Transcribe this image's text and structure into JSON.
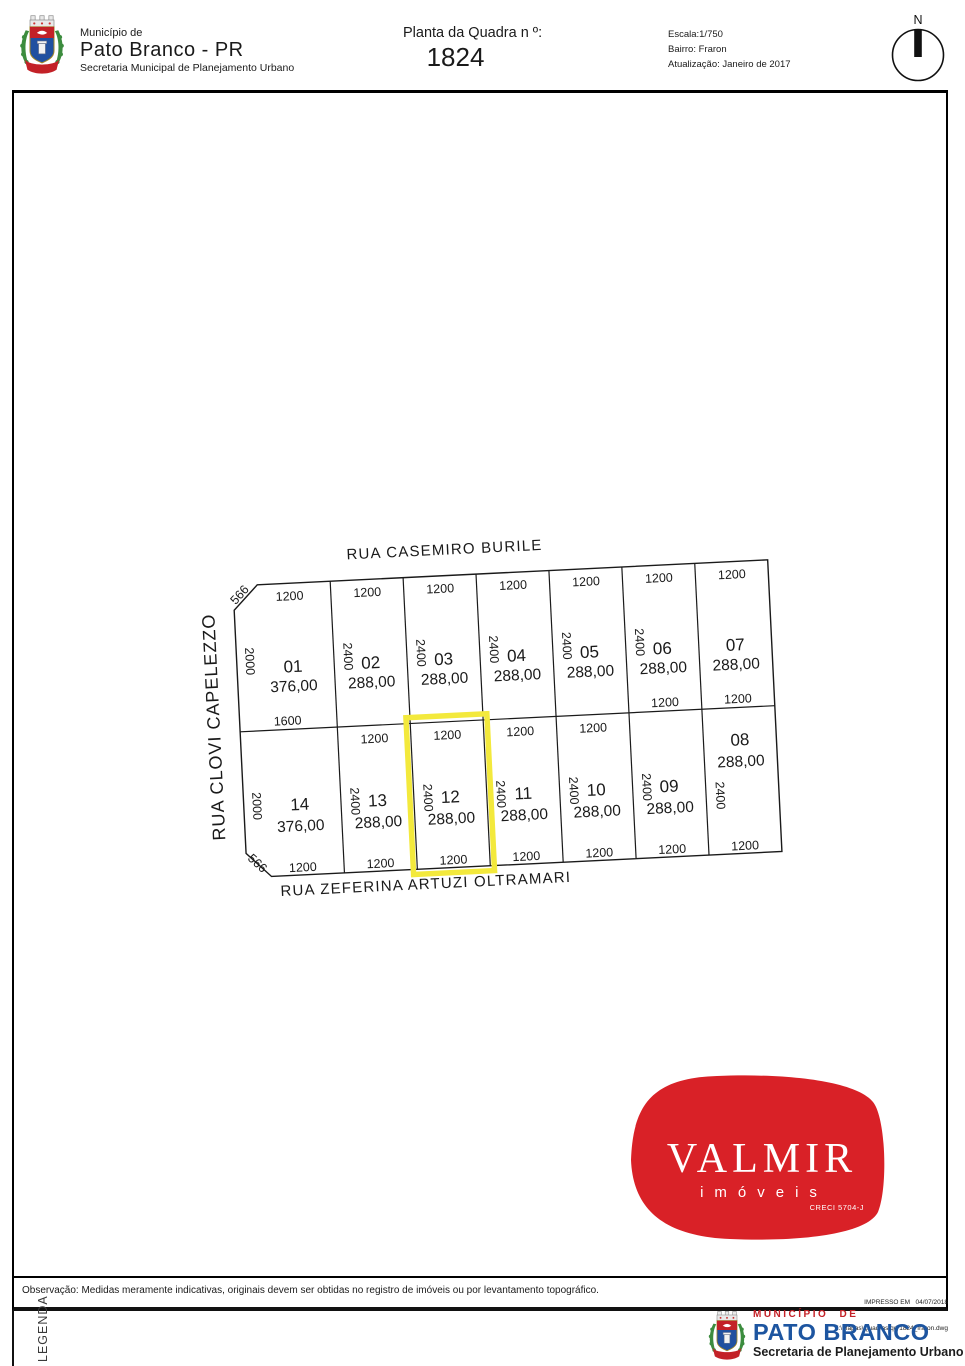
{
  "header": {
    "municipality_label": "Município de",
    "municipality": "Pato Branco - PR",
    "secretariat": "Secretaria Municipal de Planejamento Urbano",
    "plan_title": "Planta da Quadra n º:",
    "block_number": "1824",
    "scale": "Escala:1/750",
    "district": "Bairro: Fraron",
    "updated": "Atualização: Janeiro de 2017",
    "north_label": "N"
  },
  "map": {
    "streets": {
      "top": "RUA  CASEMIRO  BURILE",
      "left": "RUA CLOVI CAPELEZZO",
      "bottom": "RUA  ZEFERINA ARTUZI OLTRAMARI"
    },
    "highlighted_lot": "12",
    "lots": [
      {
        "id": "01",
        "row": 0,
        "col": 0,
        "area": "376,00",
        "front": "1200",
        "side": "2000",
        "back": "1600",
        "chamfer": "566"
      },
      {
        "id": "02",
        "row": 0,
        "col": 1,
        "area": "288,00",
        "front": "1200",
        "side": "2400"
      },
      {
        "id": "03",
        "row": 0,
        "col": 2,
        "area": "288,00",
        "front": "1200",
        "side": "2400"
      },
      {
        "id": "04",
        "row": 0,
        "col": 3,
        "area": "288,00",
        "front": "1200",
        "side": "2400"
      },
      {
        "id": "05",
        "row": 0,
        "col": 4,
        "area": "288,00",
        "front": "1200",
        "side": "2400"
      },
      {
        "id": "06",
        "row": 0,
        "col": 5,
        "area": "288,00",
        "front": "1200",
        "side": "2400",
        "back": "1200"
      },
      {
        "id": "07",
        "row": 0,
        "col": 6,
        "area": "288,00",
        "front": "1200",
        "back": "1200"
      },
      {
        "id": "14",
        "row": 1,
        "col": 0,
        "area": "376,00",
        "side": "2000",
        "back": "1200",
        "chamfer": "566"
      },
      {
        "id": "13",
        "row": 1,
        "col": 1,
        "area": "288,00",
        "front": "1200",
        "side": "2400",
        "back": "1200"
      },
      {
        "id": "12",
        "row": 1,
        "col": 2,
        "area": "288,00",
        "front": "1200",
        "side": "2400",
        "back": "1200",
        "highlight": true
      },
      {
        "id": "11",
        "row": 1,
        "col": 3,
        "area": "288,00",
        "front": "1200",
        "side": "2400",
        "back": "1200"
      },
      {
        "id": "10",
        "row": 1,
        "col": 4,
        "area": "288,00",
        "front": "1200",
        "side": "2400",
        "back": "1200"
      },
      {
        "id": "09",
        "row": 1,
        "col": 5,
        "area": "288,00",
        "side": "2400",
        "back": "1200"
      },
      {
        "id": "08",
        "row": 1,
        "col": 6,
        "area": "288,00",
        "side": "2400",
        "back": "1200",
        "label_offset": -43,
        "side_offset": 12
      }
    ]
  },
  "valmir": {
    "name": "VALMIR",
    "tagline": "imóveis",
    "creci": "CRECI 5704-J"
  },
  "footer": {
    "observation": "Observação: Medidas meramente indicativas, originais devem ser obtidas no registro de imóveis ou por levantamento topográfico.",
    "legend_label": "LEGENDA",
    "printed": "IMPRESSO EM   04/07/2018",
    "file_path": "Z:\\Mapas\\Quadras\\qd 1824_fraron.dwg",
    "logo_line1": "MUNICÍPIO DE",
    "logo_line2": "PATO BRANCO",
    "logo_line3": "Secretaria de Planejamento Urbano"
  },
  "colors": {
    "highlight": "#f3e93c",
    "valmir_red": "#d92127",
    "logo_blue": "#1d55a0",
    "logo_red": "#c42127",
    "line": "#1a1a1a"
  }
}
